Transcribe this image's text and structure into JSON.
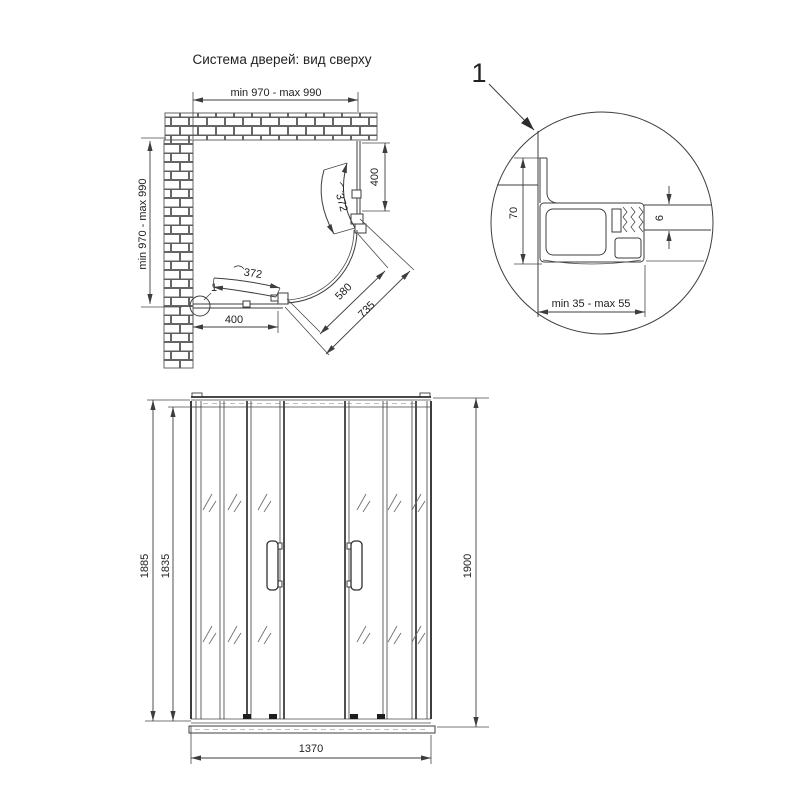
{
  "title": "Система дверей: вид сверху",
  "plan": {
    "dim_width_top": "min 970 - max 990",
    "dim_depth_left": "min 970 - max 990",
    "dim_side_panel": "400",
    "dim_bottom_panel": "400",
    "dim_door_arc_upper": "⌒372",
    "dim_door_arc_lower": "⌒372",
    "dim_opening_inner": "580",
    "dim_opening_outer": "735",
    "detail_marker": "1"
  },
  "detail": {
    "callout": "1",
    "dim_profile_depth": "70",
    "dim_glass_thickness": "6",
    "dim_adjustment_range": "min 35 - max 55"
  },
  "front": {
    "dim_frame_height": "1885",
    "dim_glass_height": "1835",
    "dim_total_height": "1900",
    "dim_total_width": "1370"
  }
}
